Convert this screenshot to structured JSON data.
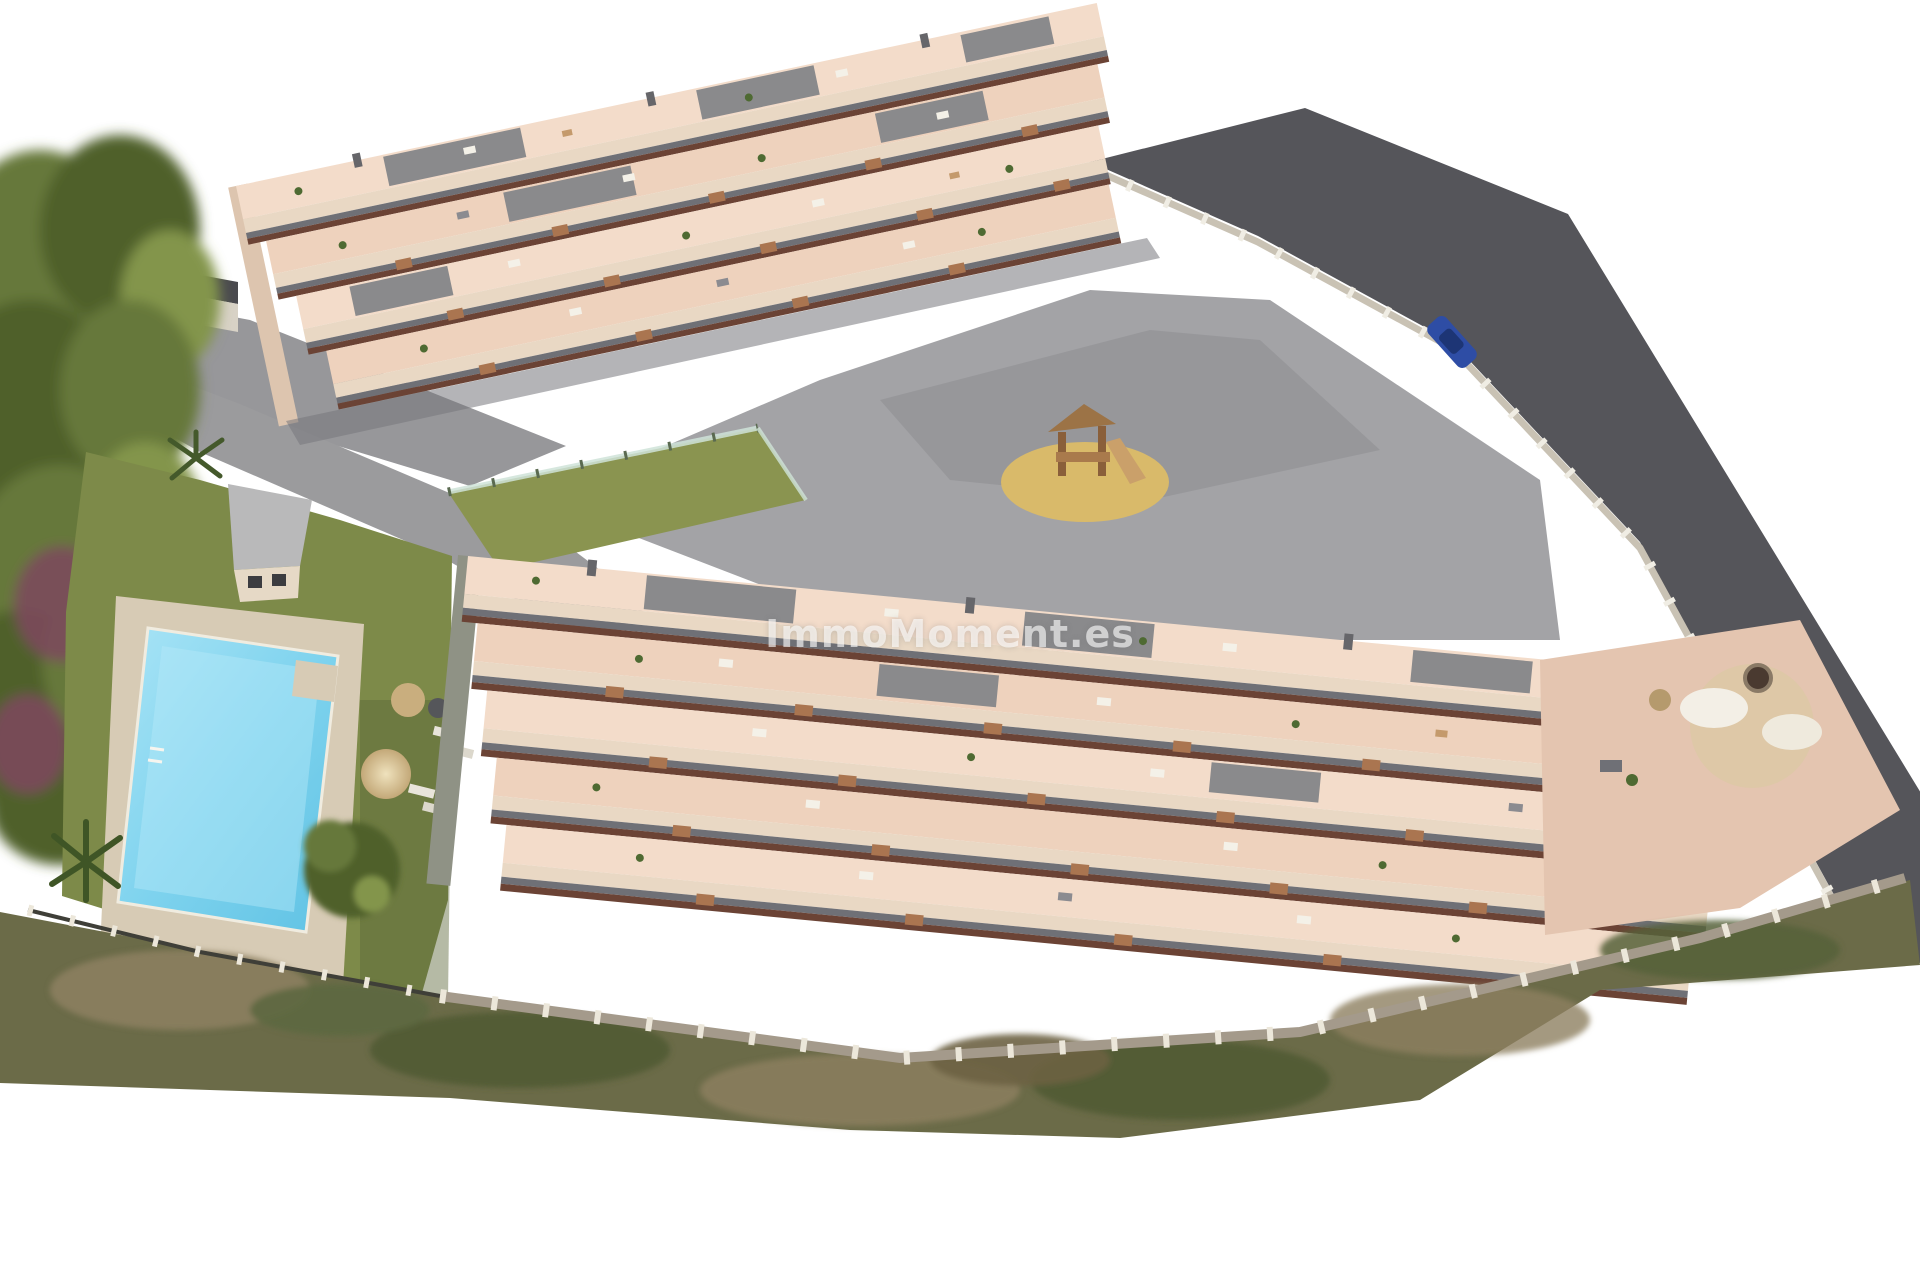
{
  "page": {
    "background_color": "#ffffff"
  },
  "watermark": {
    "text": "ImmoMoment.es",
    "color": "#ffffff",
    "opacity": 0.62
  },
  "palette": {
    "terrace_pink": "#eed2bd",
    "terrace_pink_light": "#f3dcca",
    "wall_cream": "#e9d8c4",
    "roof_gray": "#8a8a8c",
    "balcony_gray": "#6f7076",
    "under_balcony_brown": "#6b4335",
    "stairs_wood": "#aa7550",
    "paving_gray": "#a3a3a6",
    "path_gray": "#97979a",
    "road_dark": "#55555a",
    "lawn_green": "#7d8a49",
    "pitch_green": "#8a9450",
    "pool_water": "#7fd3ee",
    "pool_water_light": "#b5e9f8",
    "deck_beige": "#d7cbb5",
    "sand_yellow": "#d9ba6a",
    "tree_dark": "#4f602c",
    "tree_mid": "#66783a",
    "tree_light": "#83954b",
    "shrub_purple": "#7b4a5c",
    "brush_olive": "#6b6b48",
    "brush_brown": "#8d8060",
    "stone_wall": "#a49a8b",
    "fence_white": "#ece7da",
    "glass_fence": "#cfe3d8",
    "car_blue": "#2e4da5",
    "se_terrace_pink": "#e4c5b0",
    "dark_roof_wall": "#4a4a4e"
  },
  "scene": {
    "description_elements": [
      "pine-woodland",
      "purple-shrubs",
      "boundary-wall",
      "access-driveway",
      "paved-courtyard",
      "sports-pitch",
      "glass-fence",
      "playground-sand-pit",
      "playground-structure",
      "perimeter-road",
      "roadside-fence",
      "parked-car",
      "upper-apartment-block",
      "rooftop-terraces",
      "balconies",
      "wooden-stairs",
      "communal-lawn",
      "pool-deck",
      "swimming-pool",
      "kids-pool",
      "pool-house",
      "sun-parasol",
      "sun-loungers",
      "round-daybed",
      "garden-trees",
      "palm-tree",
      "lower-apartment-block",
      "south-east-terrace",
      "outdoor-lounge-furniture",
      "fire-pit",
      "stone-perimeter-wall",
      "white-post-fence",
      "scrub-slope"
    ]
  }
}
